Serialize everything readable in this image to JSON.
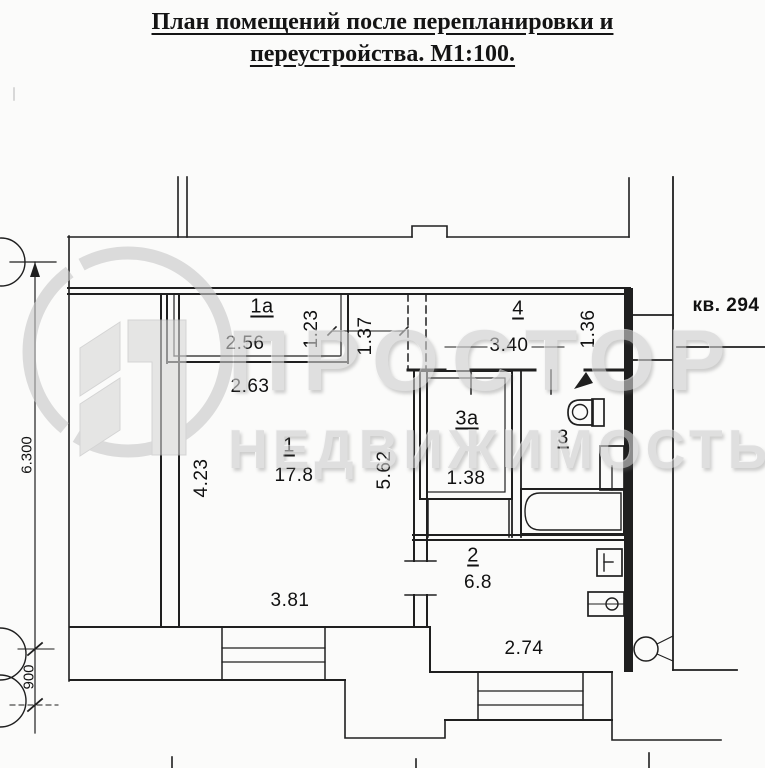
{
  "title": {
    "line1": "План помещений после перепланировки и",
    "line2": "переустройства. М1:100."
  },
  "watermark": {
    "line1": "ПРОСТОР",
    "line2": "НЕДВИЖИМОСТЬ"
  },
  "plan": {
    "apartment_ref": "кв. 294",
    "room_labels": {
      "r1": "1",
      "r1a": "1а",
      "r2": "2",
      "r3": "3",
      "r3a": "3а",
      "r4": "4"
    },
    "areas": {
      "room1": "17.8",
      "room2": "6.8",
      "room3a": "1.38"
    },
    "dimensions": {
      "room1a_width": "2.56",
      "room1a_depth": "1.23",
      "nook_depth": "1.37",
      "room1_top_width": "2.63",
      "room1_left_depth": "4.23",
      "room1_right_depth": "5.62",
      "room1_bottom_width": "3.81",
      "room4_width": "3.40",
      "room4_depth": "1.36",
      "room2_bottom_width": "2.74",
      "axis_span": "6.300",
      "axis_offset": "900"
    }
  }
}
